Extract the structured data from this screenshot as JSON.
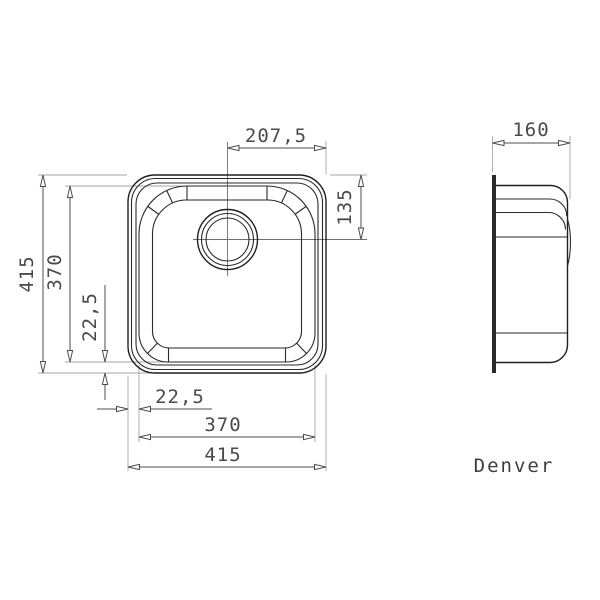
{
  "drawing": {
    "model_name": "Denver",
    "plan_view": {
      "dim_center_to_right_edge": "207,5",
      "dim_overall_height": "415",
      "dim_inner_height": "370",
      "dim_bottom_inset_vertical": "22,5",
      "dim_drain_center_from_top": "135",
      "dim_left_inset_horizontal": "22,5",
      "dim_inner_width": "370",
      "dim_overall_width": "415"
    },
    "side_view": {
      "dim_depth": "160"
    },
    "colors": {
      "background": "#ffffff",
      "outline": "#1f1f1f",
      "dimension": "#4d4d4d",
      "extension": "#a6a6a6",
      "text": "#4a4a4a"
    }
  }
}
